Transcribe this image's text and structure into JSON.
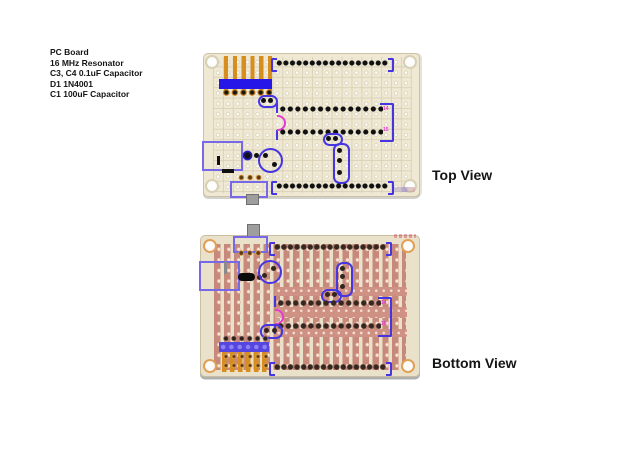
{
  "notes": {
    "lines": [
      "PC Board",
      "16 MHz Resonator",
      "C3, C4 0.1uF Capacitor",
      "D1 1N4001",
      "C1 100uF Capacitor"
    ]
  },
  "labels": {
    "top_view": "Top View",
    "bottom_view": "Bottom View"
  },
  "top_board": {
    "pin_label_top": "14",
    "pin_label_bottom": "15"
  },
  "bottom_board": {
    "pin_label_top": "14",
    "pin_label_bottom": "15"
  },
  "colors": {
    "board_beige": "#EFE8D2",
    "copper_strip": "#C6897B",
    "copper_pad": "#E2AE9A",
    "trace_orange": "#D78E1F",
    "outline_blue": "#4636E2",
    "outline_periwinkle": "#7668E6",
    "solid_blue": "#2617E8",
    "solid_violet": "#5546E0",
    "magenta": "#E43BD0",
    "dot_black": "#101010",
    "dot_brown": "#35271F",
    "tab_gray": "#9E9E9E"
  }
}
